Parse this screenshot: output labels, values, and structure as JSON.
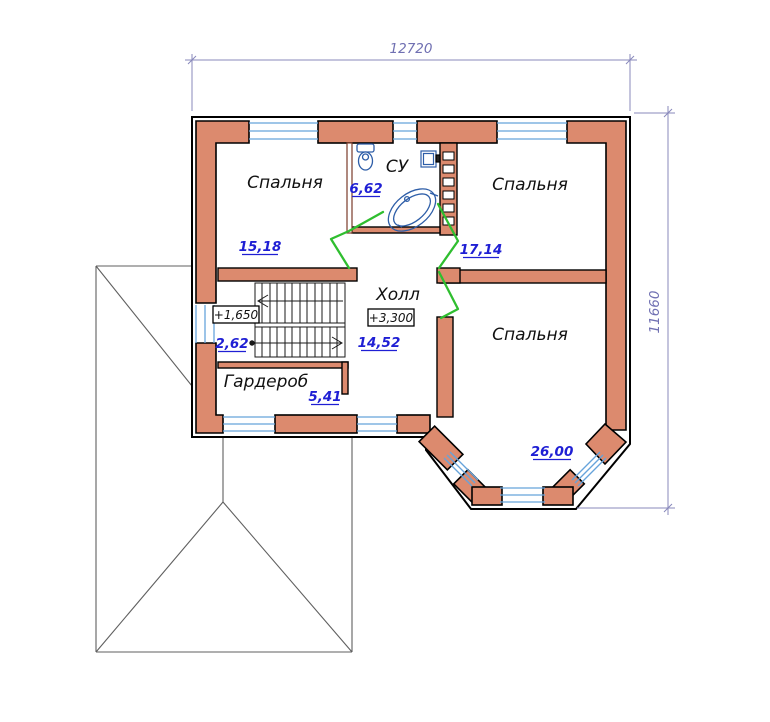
{
  "dimensions": {
    "width": "12720",
    "height": "11660"
  },
  "rooms": {
    "bedroom1": {
      "name": "Спальня",
      "area": "15,18"
    },
    "bathroom": {
      "name": "СУ",
      "area": "6,62"
    },
    "bedroom2": {
      "name": "Спальня",
      "area": "17,14"
    },
    "hall": {
      "name": "Холл",
      "area": "14,52",
      "level": "+3,300"
    },
    "wardrobe": {
      "name": "Гардероб",
      "area": "5,41"
    },
    "bedroom3": {
      "name": "Спальня",
      "area": "26,00"
    },
    "stairs": {
      "area": "2,62",
      "level": "+1,650"
    }
  },
  "symbols": {
    "toilet": "toilet-symbol",
    "bathtub": "corner-bathtub-symbol",
    "sink": "sink-symbol",
    "vent_shaft": "vent-shaft-symbol",
    "stairs": "stair-flights-symbol",
    "doors": "open-door-symbol",
    "roof": "lower-roof-outline"
  },
  "colors": {
    "wall_fill": "#DC8A6E",
    "window_blue": "#66A3DB",
    "area_text_blue": "#1F1FD4",
    "dimension_blue": "#7878B8",
    "door_green": "#2FBE2F",
    "roof_gray": "#5F5F5F",
    "fixture_blue": "#2E5EA8"
  }
}
